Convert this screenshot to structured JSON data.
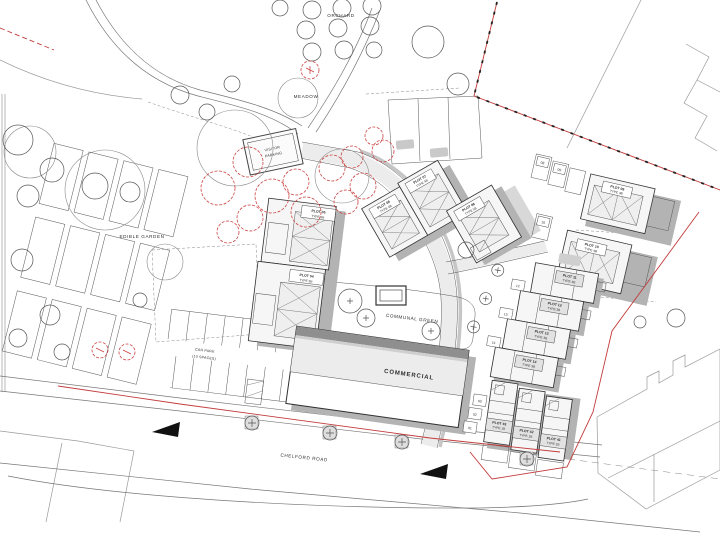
{
  "plan": {
    "areas": {
      "orchard": "ORCHARD",
      "meadow": "MEADOW",
      "edible_garden": "EDIBLE GARDEN",
      "communal_green": "COMMUNAL GREEN",
      "commercial": "COMMERCIAL",
      "car_park_1": "CAR PARK",
      "car_park_2": "(10 SPACES)",
      "visitor_1": "VISITOR",
      "visitor_2": "PARKING",
      "road": "CHELFORD ROAD"
    },
    "plots": [
      {
        "name": "PLOT 04",
        "type": "TYPE 5B"
      },
      {
        "name": "PLOT 05",
        "type": "TYPE 5B"
      },
      {
        "name": "PLOT 06",
        "type": "TYPE 4B"
      },
      {
        "name": "PLOT 07",
        "type": "TYPE 4B"
      },
      {
        "name": "PLOT 08",
        "type": "TYPE 5B"
      },
      {
        "name": "PLOT 09",
        "type": "TYPE 4B"
      },
      {
        "name": "PLOT 10",
        "type": "TYPE 4B"
      },
      {
        "name": "PLOT 11",
        "type": "TYPE 3B"
      },
      {
        "name": "PLOT 12",
        "type": "TYPE 3B"
      },
      {
        "name": "PLOT 13",
        "type": "TYPE 3B"
      },
      {
        "name": "PLOT 14",
        "type": "TYPE 3B"
      },
      {
        "name": "PLOT 41",
        "type": "TYPE 1B"
      },
      {
        "name": "PLOT 42",
        "type": "TYPE 1B"
      },
      {
        "name": "PLOT 43",
        "type": "TYPE 1B"
      }
    ],
    "bays": {
      "n01": "01",
      "n02": "02",
      "n03": "03",
      "n08": "08",
      "n09": "09",
      "n10": "10",
      "n12": "12",
      "n13": "13",
      "n14": "14"
    }
  }
}
